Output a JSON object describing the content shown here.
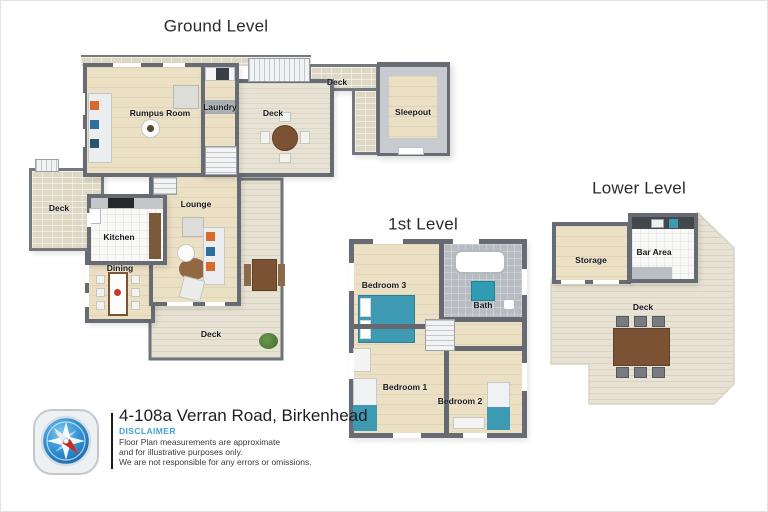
{
  "plans": {
    "ground": {
      "title": "Ground Level",
      "rooms": {
        "rumpus_room": "Rumpus Room",
        "laundry": "Laundry",
        "deck_main": "Deck",
        "deck_walkway": "Deck",
        "sleepout": "Sleepout",
        "deck_left": "Deck",
        "kitchen": "Kitchen",
        "dining": "Dining",
        "lounge": "Lounge",
        "deck_bottom": "Deck"
      }
    },
    "first": {
      "title": "1st Level",
      "rooms": {
        "bedroom_3": "Bedroom 3",
        "bath": "Bath",
        "bedroom_1": "Bedroom 1",
        "bedroom_2": "Bedroom 2"
      }
    },
    "lower": {
      "title": "Lower Level",
      "rooms": {
        "storage": "Storage",
        "bar_area": "Bar Area",
        "deck": "Deck"
      }
    }
  },
  "footer": {
    "address": "4-108a Verran Road, Birkenhead",
    "disclaimer_title": "DISCLAIMER",
    "disclaimer_lines": [
      "Floor Plan measurements are approximate",
      "and for illustrative purposes only.",
      "We are not responsible for any errors or omissions."
    ]
  },
  "colors": {
    "wall": "#676c74",
    "wood_floor": "#ebdfc4",
    "deck_floor": "#e7e2d3",
    "tile_floor": "#f8f8f6",
    "accent_blue": "#42a0d4",
    "teal": "#3d9ab2",
    "table_brown": "#7b5334"
  }
}
